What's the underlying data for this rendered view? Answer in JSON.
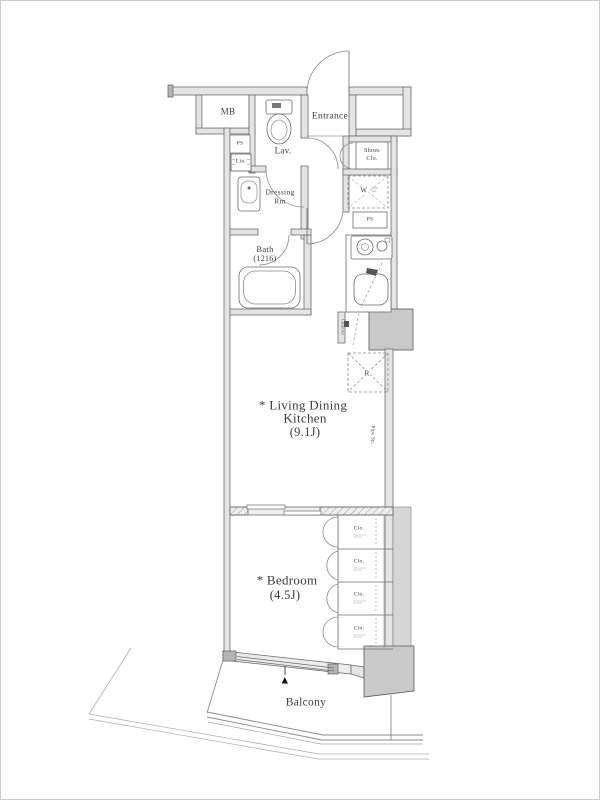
{
  "plan": {
    "rooms": {
      "mb": "MB",
      "entrance": "Entrance",
      "lav": "Lav.",
      "shoes_l1": "Shoes",
      "shoes_l2": "Clo.",
      "dressing_l1": "Dressing",
      "dressing_l2": "Rm",
      "bath_l1": "Bath",
      "bath_l2": "(1216)",
      "ldk_l1": "* Living Dining",
      "ldk_l2": "Kitchen",
      "ldk_l3": "(9.1J)",
      "bedroom_l1": "* Bedroom",
      "bedroom_l2": "(4.5J)",
      "balcony": "Balcony"
    },
    "fixtures": {
      "ps_left": "PS",
      "linen": "Lin.",
      "ps_right": "PS",
      "washer": "W",
      "refrigerator": "R",
      "closet_1": "Clo.",
      "closet_2": "Clo.",
      "closet_3": "Clo.",
      "closet_4": "Clo.",
      "counter_vertical": "Counter",
      "pipe_vertical": "Pipe Sp.",
      "direction_marker": "▲"
    },
    "colors": {
      "line": "#6b6b6b",
      "wall_fill": "#e4e4e4",
      "column_fill": "#c9c9c9",
      "hatch_fill": "#d6d6d6",
      "text": "#3b3b3b",
      "marker": "#111111"
    }
  }
}
